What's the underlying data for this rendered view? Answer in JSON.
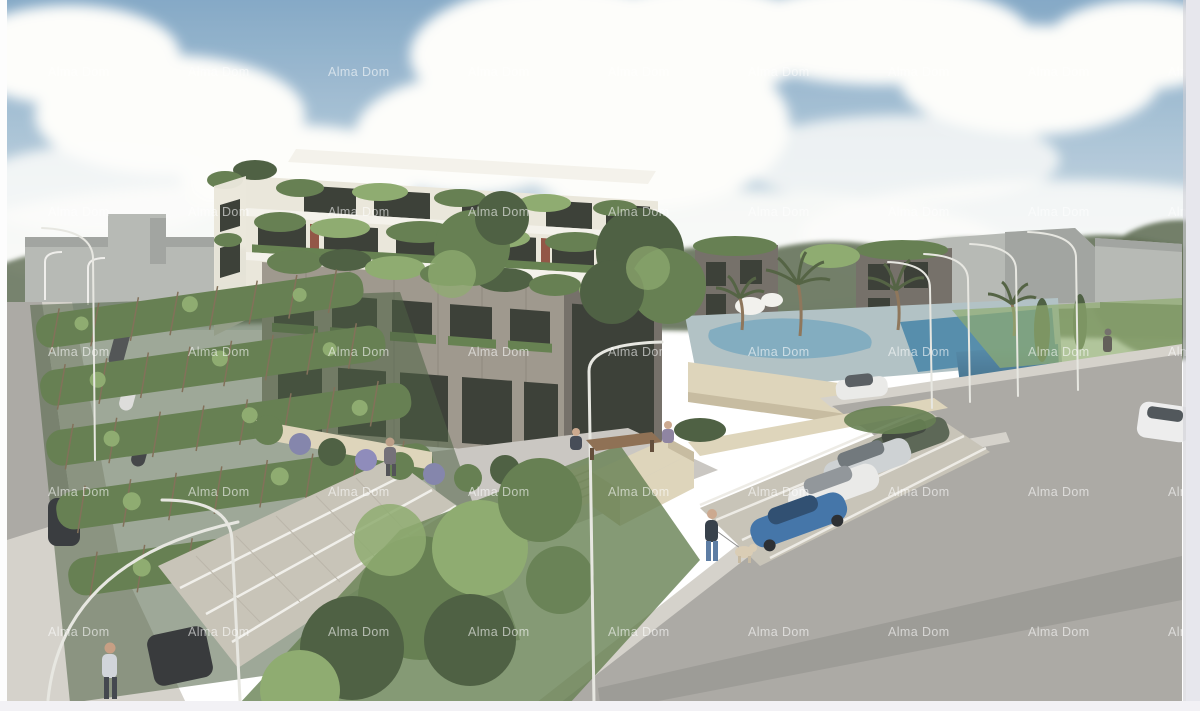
{
  "image": {
    "type": "architectural-rendering",
    "subject": "Aerial 3D visualization of a modern residential apartment complex with rooftop balcony gardens, swimming pool with palm trees, roadside parking with cars, vine-covered pergola parking and pedestrians",
    "watermark": {
      "text": "Alma Dom",
      "color": "#ffffff",
      "opacity": 0.58,
      "font_size": 12.5,
      "columns": [
        48,
        188,
        328,
        468,
        608,
        748,
        888,
        1028,
        1168
      ],
      "rows": [
        76,
        216,
        356,
        496,
        636
      ]
    }
  },
  "palette": {
    "sky_top": "#7fa5c4",
    "sky_mid": "#b5cbda",
    "sky_horizon": "#e5eae8",
    "cloud": "#fdfdfa",
    "cloud_shadow": "#e2e3e1",
    "treeline": "#5d6b52",
    "massing_gray": "#b4b7b2",
    "massing_dark": "#9ea19c",
    "bldg_white_slab": "#f4f2ea",
    "bldg_white_face": "#e9e6da",
    "window_dark": "#33372f",
    "planter_green": "#5f7c49",
    "foliage_dark": "#46593a",
    "foliage_mid": "#5f7a4a",
    "foliage_light": "#8aa86a",
    "facade_taupe": "#9a9488",
    "facade_taupe_dark": "#6f6a62",
    "stone_wall": "#ddd3b8",
    "stone_wall_shadow": "#c4b99c",
    "pool_deck": "#aebfc2",
    "pool_water": "#74a4bc",
    "pool_water_deep": "#4f88a8",
    "road": "#a8a6a1",
    "road_light": "#c8c5bf",
    "sidewalk": "#d3d0c9",
    "gravel": "#c6c1b5",
    "accent_red": "#8e4f3e",
    "trellis_brown": "#7d6a52",
    "lamp": "#e6e6e0",
    "car_blue": "#3c6fa5",
    "car_white": "#e9e9e7",
    "car_silver": "#ccd0d2",
    "car_dark_green": "#55604f",
    "watermark": "#ffffff",
    "border_right": "#e7e7ed",
    "border_bottom": "#f2f1f5"
  }
}
